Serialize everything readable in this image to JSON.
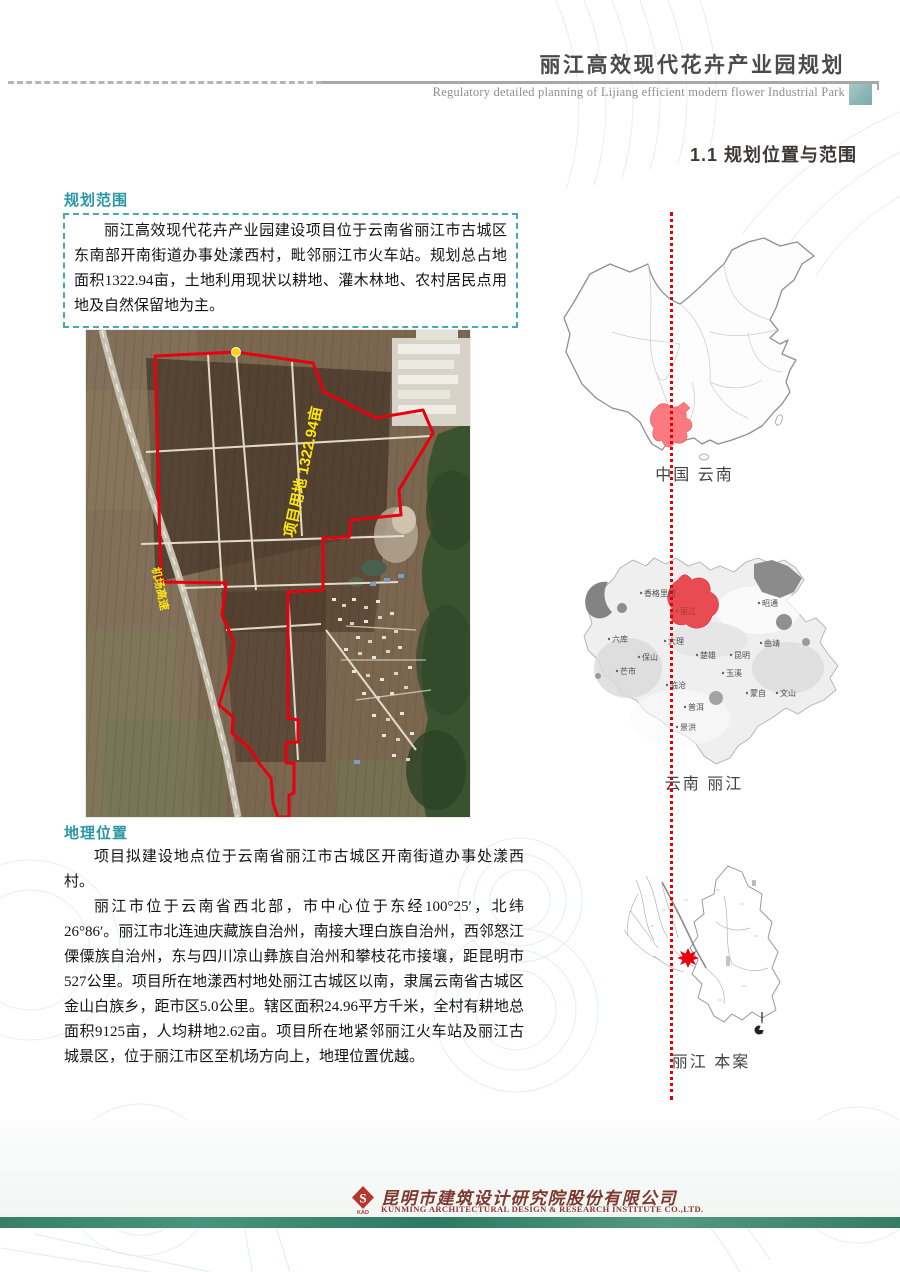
{
  "header": {
    "title_cn": "丽江高效现代花卉产业园规划",
    "title_en": "Regulatory detailed planning of Lijiang efficient modern flower Industrial Park"
  },
  "section": {
    "title": "1.1 规划位置与范围"
  },
  "planning_scope": {
    "label": "规划范围",
    "text": "丽江高效现代花卉产业园建设项目位于云南省丽江市古城区东南部开南街道办事处漾西村，毗邻丽江市火车站。规划总占地面积1322.94亩，土地利用现状以耕地、灌木林地、农村居民点用地及自然保留地为主。"
  },
  "site_map": {
    "area_label": "项目用地 1322.94亩",
    "road_label": "机场高速"
  },
  "geo_location": {
    "label": "地理位置",
    "para1": "项目拟建设地点位于云南省丽江市古城区开南街道办事处漾西村。",
    "para2": "丽江市位于云南省西北部，市中心位于东经100°25′，北纬26°86′。丽江市北连迪庆藏族自治州，南接大理白族自治州，西邻怒江傈僳族自治州，东与四川凉山彝族自治州和攀枝花市接壤，距昆明市527公里。项目所在地漾西村地处丽江古城区以南，隶属云南省古城区金山白族乡，距市区5.0公里。辖区面积24.96平方千米，全村有耕地总面积9125亩，人均耕地2.62亩。项目所在地紧邻丽江火车站及丽江古城景区，位于丽江市区至机场方向上，地理位置优越。"
  },
  "locator_maps": {
    "china_caption": "中国  云南",
    "yunnan_caption": "云南  丽江",
    "lijiang_caption": "丽江  本案",
    "yunnan_cities": [
      "香格里拉",
      "昭通",
      "丽江",
      "六库",
      "大理",
      "曲靖",
      "保山",
      "楚雄",
      "昆明",
      "芒市",
      "玉溪",
      "临沧",
      "蒙自",
      "文山",
      "普洱",
      "景洪"
    ]
  },
  "footer": {
    "company_cn": "昆明市建筑设计研究院股份有限公司",
    "company_en": "KUNMING ARCHITECTURAL DESIGN & RESEARCH INSTITUTE CO.,LTD.",
    "logo_text": "KAD"
  },
  "colors": {
    "accent_teal": "#2a97a3",
    "boundary_red": "#e8000f",
    "highlight_red": "#fb7a80",
    "dotted_line_red": "#e40000",
    "footer_bar_teal": "#357c65",
    "map_label_yellow": "#ffe60a"
  }
}
